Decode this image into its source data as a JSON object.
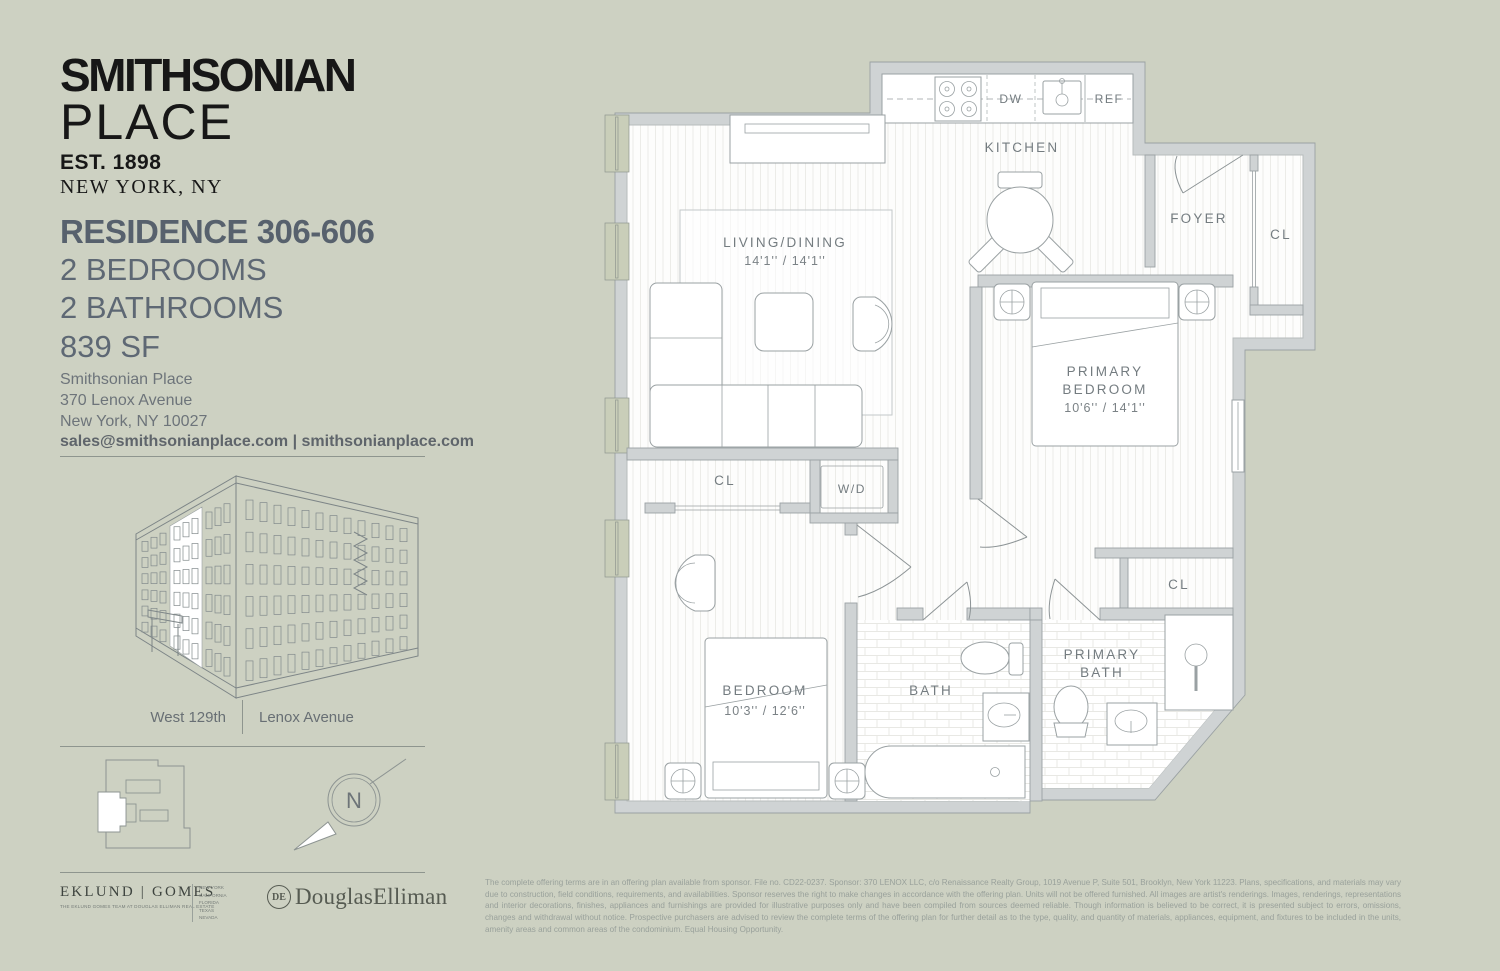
{
  "colors": {
    "background": "#cdd1c2",
    "wall_gray": "#cfd3d4",
    "window_sage": "#c9ceb9",
    "heading_slate": "#57616d",
    "label_gray": "#747c80"
  },
  "brand": {
    "name_line1": "SMITHSONIAN",
    "name_line2": "PLACE",
    "est": "EST. 1898",
    "city": "NEW YORK, NY"
  },
  "residence": {
    "title": "RESIDENCE 306-606",
    "line1": "2 BEDROOMS",
    "line2": "2 BATHROOMS",
    "line3": "839 SF"
  },
  "contact": {
    "name": "Smithsonian Place",
    "street": "370 Lenox Avenue",
    "city": "New York, NY 10027",
    "links": "sales@smithsonianplace.com | smithsonianplace.com"
  },
  "streets": {
    "left": "West 129th",
    "right": "Lenox Avenue"
  },
  "compass": {
    "north": "N"
  },
  "floorplan": {
    "kitchen": "KITCHEN",
    "dw": "DW",
    "ref": "REF",
    "foyer": "FOYER",
    "foyer_closet": "CL",
    "living_name": "LIVING/DINING",
    "living_dims": "14'1'' / 14'1''",
    "primary_name1": "PRIMARY",
    "primary_name2": "BEDROOM",
    "primary_dims": "10'6'' / 14'1''",
    "hall_closet": "CL",
    "washer_dryer": "W/D",
    "bedroom_name": "BEDROOM",
    "bedroom_dims": "10'3'' / 12'6''",
    "bath": "BATH",
    "primary_bath1": "PRIMARY",
    "primary_bath2": "BATH",
    "primary_closet": "CL"
  },
  "brokers": {
    "eklund_gomes": "EKLUND | GOMES",
    "eklund_tagline": "THE EKLUND GOMES TEAM AT DOUGLAS ELLIMAN REAL ESTATE",
    "eklund_regions": "NEW YORK\nCALIFORNIA\nFLORIDA\nTEXAS\nNEVADA",
    "de_monogram": "DE",
    "douglas_elliman": "DouglasElliman"
  },
  "disclaimer": {
    "text": "The complete offering terms are in an offering plan available from sponsor. File no. CD22-0237. Sponsor: 370 LENOX LLC, c/o Renaissance Realty Group, 1019 Avenue P, Suite 501, Brooklyn, New York 11223. Plans, specifications, and materials may vary due to construction, field conditions, requirements, and availabilities. Sponsor reserves the right to make changes in accordance with the offering plan. Units will not be offered furnished. All images are artist's renderings. Images, renderings, representations and interior decorations, finishes, appliances and furnishings are provided for illustrative purposes only and have been compiled from sources deemed reliable. Though information is believed to be correct, it is presented subject to errors, omissions, changes and withdrawal without notice. Prospective purchasers are advised to review the complete terms of the offering plan for further detail as to the type, quality, and quantity of materials, appliances, equipment, and fixtures to be included in the units, amenity areas and common areas of the condominium. Equal Housing Opportunity."
  }
}
